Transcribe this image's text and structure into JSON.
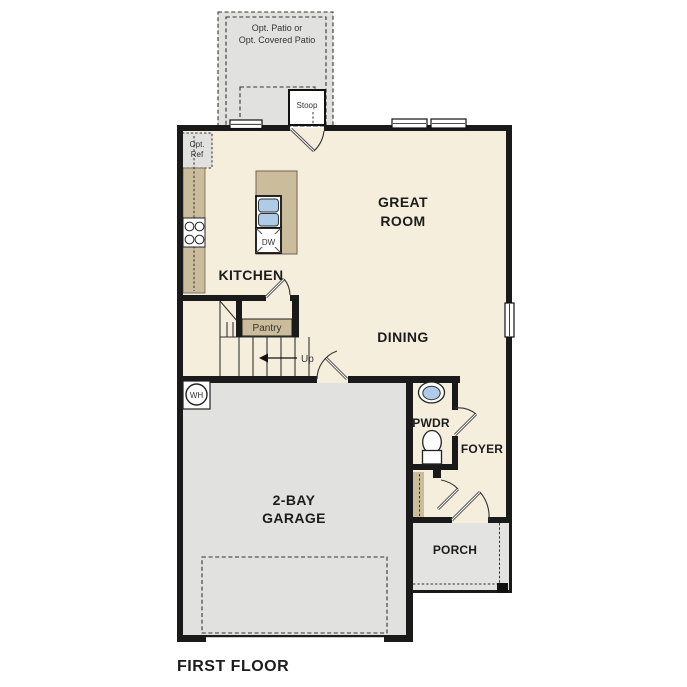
{
  "plan": {
    "title": "FIRST FLOOR",
    "patio": {
      "line1": "Opt. Patio or",
      "line2": "Opt. Covered Patio"
    },
    "stoop": "Stoop",
    "opt_ref": {
      "line1": "Opt.",
      "line2": "Ref"
    },
    "kitchen": "KITCHEN",
    "great_room": {
      "line1": "GREAT",
      "line2": "ROOM"
    },
    "dining": "DINING",
    "pantry": "Pantry",
    "up": "Up",
    "dw": "DW",
    "wh": "WH",
    "pwdr": "PWDR",
    "foyer": "FOYER",
    "garage": {
      "line1": "2-BAY",
      "line2": "GARAGE"
    },
    "porch": "PORCH"
  },
  "colors": {
    "floor": "#f6eedc",
    "cabinet": "#cbbc9c",
    "gray": "#e1e1e0",
    "porch": "#e3e3e2",
    "wall": "#1a1a1a",
    "sink": "#aecbe8"
  }
}
